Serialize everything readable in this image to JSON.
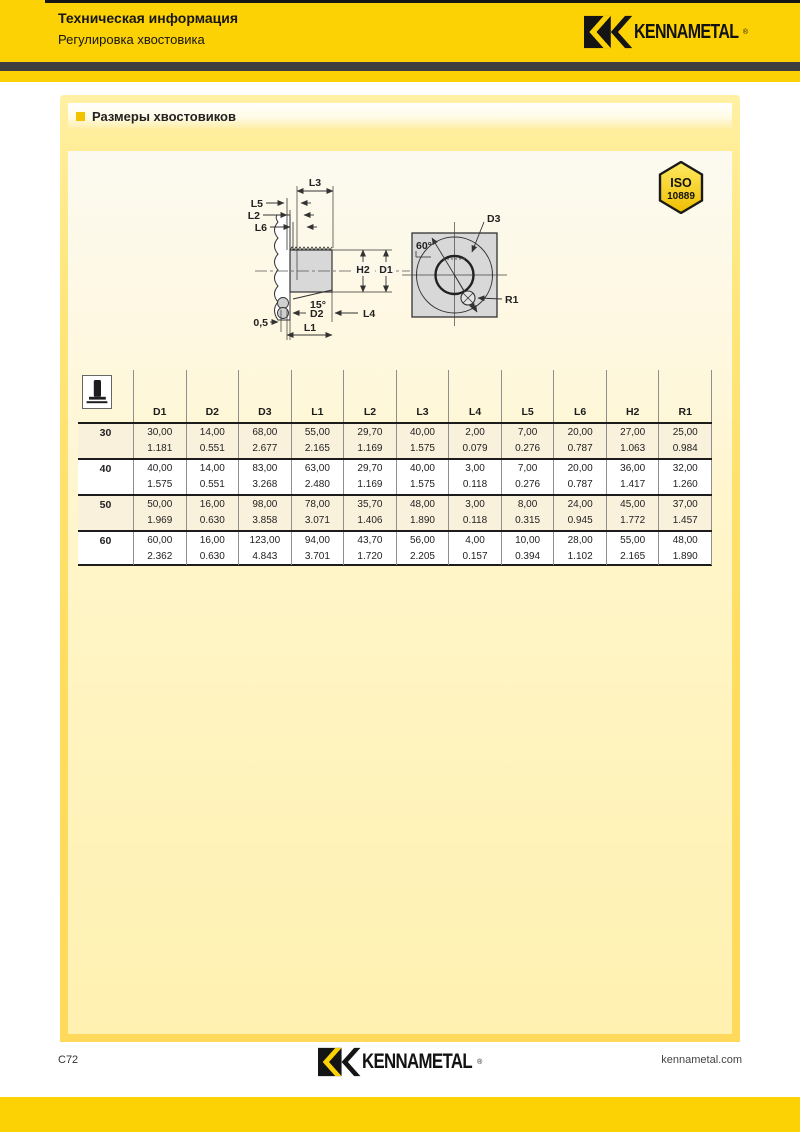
{
  "header": {
    "title": "Техническая информация",
    "subtitle": "Регулировка хвостовика",
    "brand": "KENNAMETAL",
    "brand_reg": "®"
  },
  "section": {
    "title": "Размеры хвостовиков"
  },
  "badge": {
    "line1": "ISO",
    "line2": "10889"
  },
  "drawing": {
    "labels": {
      "l3": "L3",
      "l5": "L5",
      "l2": "L2",
      "l6": "L6",
      "h2": "H2",
      "d1": "D1",
      "angle15": "15°",
      "d2": "D2",
      "l4": "L4",
      "gap": "0,5",
      "l1": "L1",
      "d3": "D3",
      "angle60": "60°",
      "r1": "R1"
    }
  },
  "table": {
    "columns": [
      "D1",
      "D2",
      "D3",
      "L1",
      "L2",
      "L3",
      "L4",
      "L5",
      "L6",
      "H2",
      "R1"
    ],
    "rows": [
      {
        "size": "30",
        "mm": [
          "30,00",
          "14,00",
          "68,00",
          "55,00",
          "29,70",
          "40,00",
          "2,00",
          "7,00",
          "20,00",
          "27,00",
          "25,00"
        ],
        "inch": [
          "1.181",
          "0.551",
          "2.677",
          "2.165",
          "1.169",
          "1.575",
          "0.079",
          "0.276",
          "0.787",
          "1.063",
          "0.984"
        ]
      },
      {
        "size": "40",
        "mm": [
          "40,00",
          "14,00",
          "83,00",
          "63,00",
          "29,70",
          "40,00",
          "3,00",
          "7,00",
          "20,00",
          "36,00",
          "32,00"
        ],
        "inch": [
          "1.575",
          "0.551",
          "3.268",
          "2.480",
          "1.169",
          "1.575",
          "0.118",
          "0.276",
          "0.787",
          "1.417",
          "1.260"
        ]
      },
      {
        "size": "50",
        "mm": [
          "50,00",
          "16,00",
          "98,00",
          "78,00",
          "35,70",
          "48,00",
          "3,00",
          "8,00",
          "24,00",
          "45,00",
          "37,00"
        ],
        "inch": [
          "1.969",
          "0.630",
          "3.858",
          "3.071",
          "1.406",
          "1.890",
          "0.118",
          "0.315",
          "0.945",
          "1.772",
          "1.457"
        ]
      },
      {
        "size": "60",
        "mm": [
          "60,00",
          "16,00",
          "123,00",
          "94,00",
          "43,70",
          "56,00",
          "4,00",
          "10,00",
          "28,00",
          "55,00",
          "48,00"
        ],
        "inch": [
          "2.362",
          "0.630",
          "4.843",
          "3.701",
          "1.720",
          "2.205",
          "0.157",
          "0.394",
          "1.102",
          "2.165",
          "1.890"
        ]
      }
    ]
  },
  "footer": {
    "page_number": "C72",
    "brand": "KENNAMETAL",
    "website": "kennametal.com"
  },
  "colors": {
    "brand_yellow": "#FCD205",
    "dark_bar": "#3E3E40",
    "panel_yellow": "#FFD95B",
    "table_stripe": "#FAF1DC",
    "ink": "#1A1A1A"
  }
}
